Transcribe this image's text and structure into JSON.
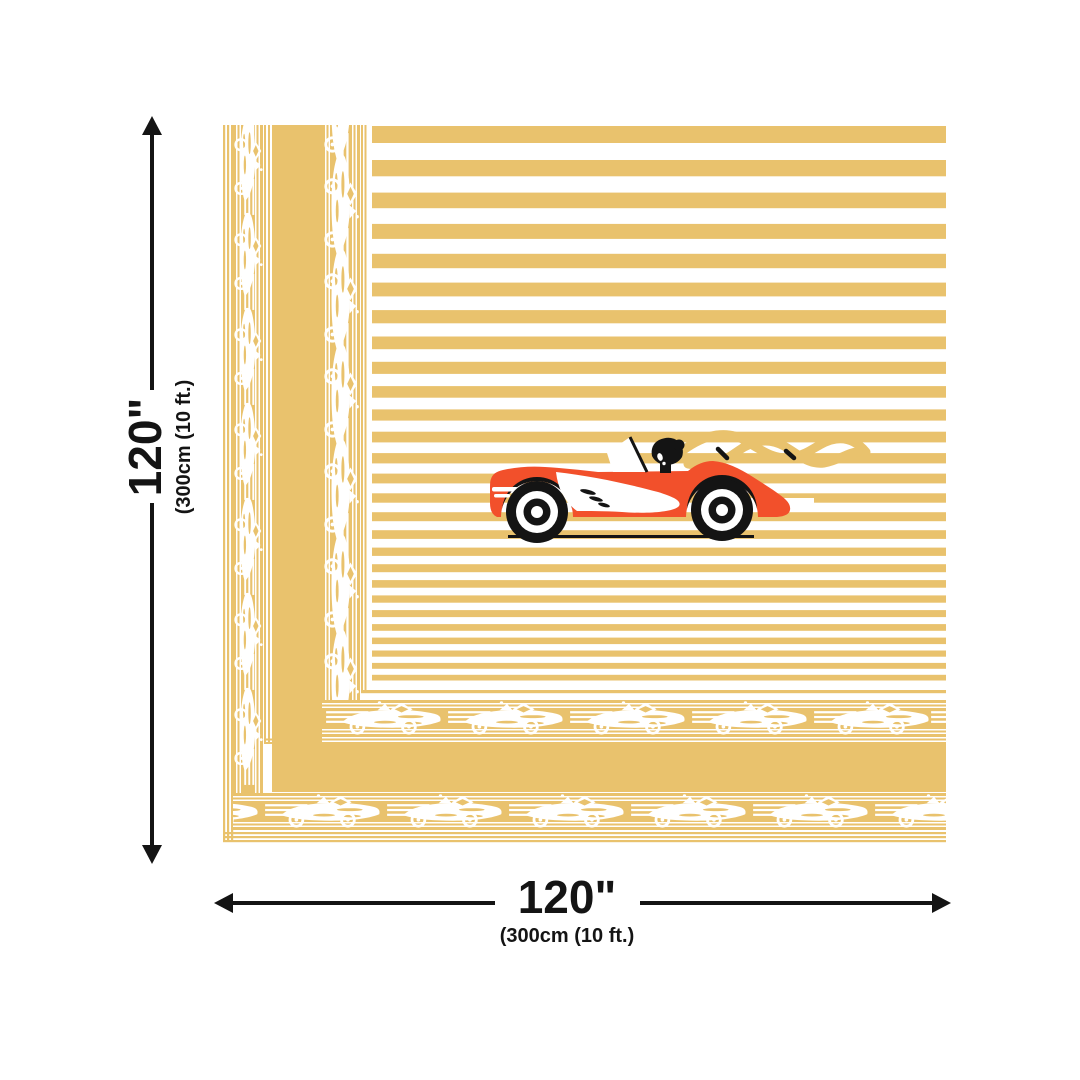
{
  "colors": {
    "gold": "#E9C26D",
    "red": "#F2502B",
    "ink": "#141414",
    "white": "#FFFFFF"
  },
  "panel": {
    "theme": "vintage race car striped panel",
    "motifs": [
      "race-car-motif",
      "speed-lines",
      "diamond-ornament",
      "horizontal-stripes"
    ],
    "hero": [
      "red-convertible",
      "lady-driver-silhouette",
      "wind-scarf-swirl",
      "ground-line"
    ]
  },
  "dimensions": {
    "height": {
      "primary": "120\"",
      "secondary": "(300cm (10 ft.)"
    },
    "width": {
      "primary": "120\"",
      "secondary": "(300cm (10 ft.)"
    }
  }
}
